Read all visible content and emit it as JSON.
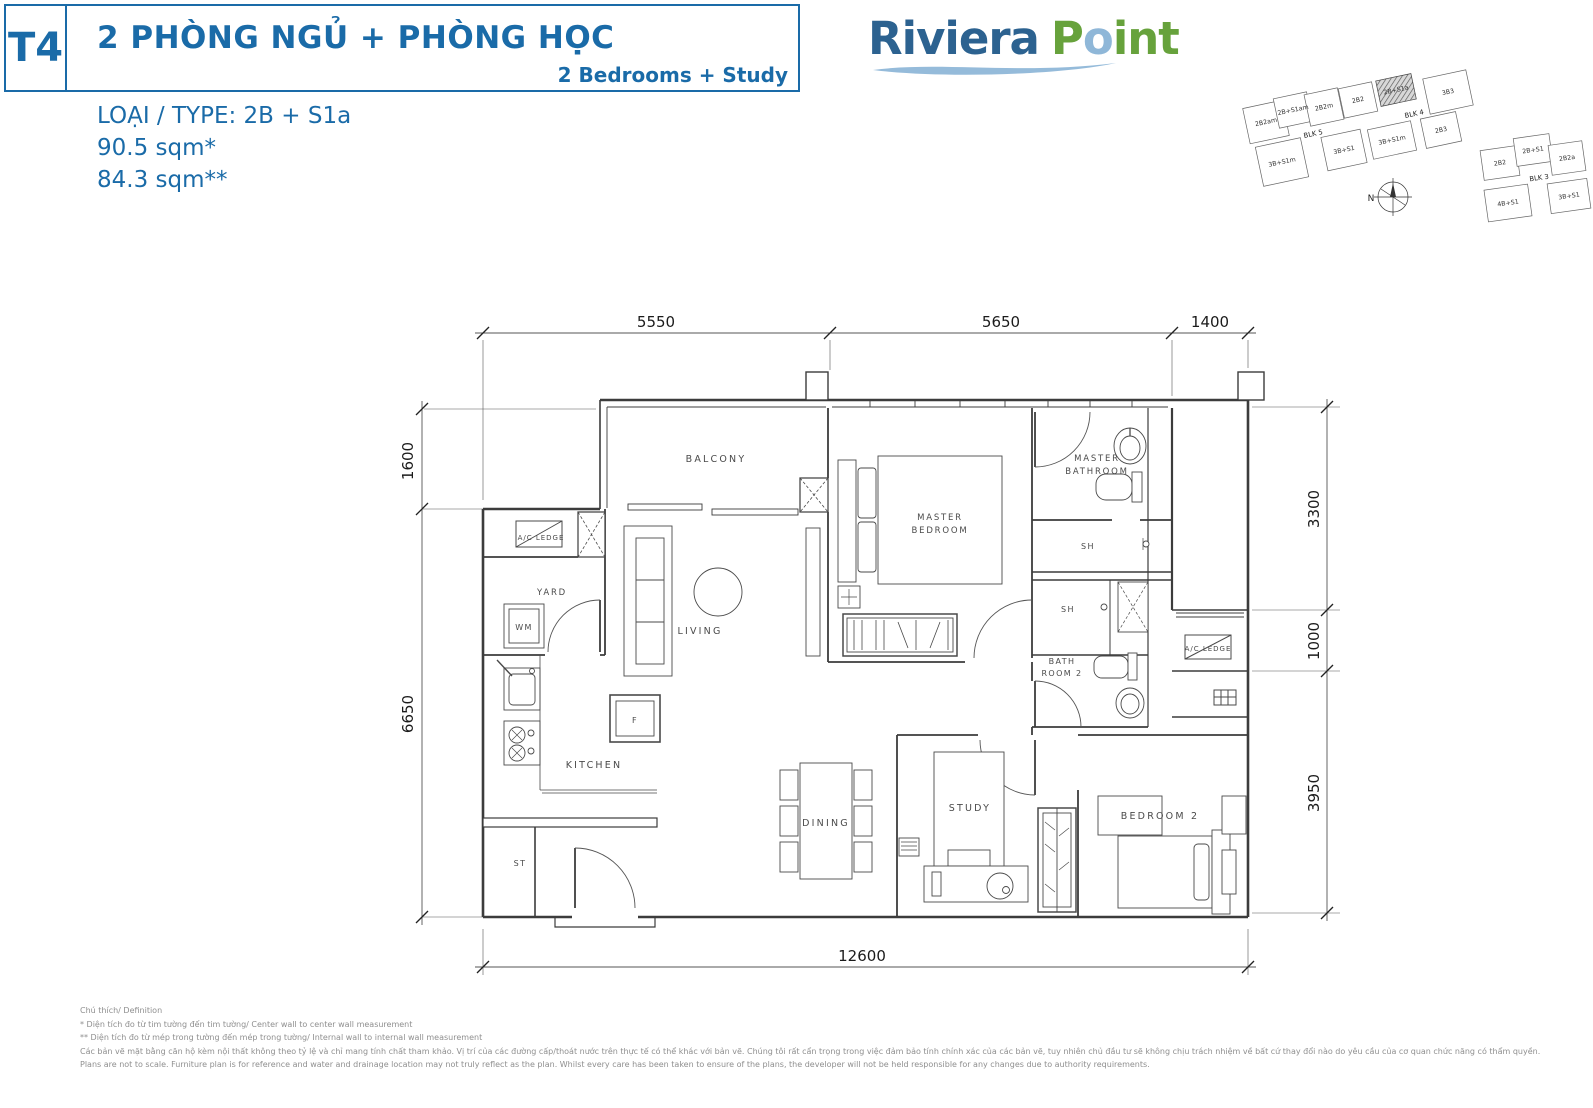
{
  "theme": {
    "brand-blue": "#1A6BA8",
    "logo-blue": "#2C6290",
    "logo-green": "#67A23C",
    "logo-light-blue": "#8FB7D8",
    "plan-line": "#3c3c3c",
    "label-gray": "#4a4a4a",
    "footer-gray": "#8f8f8f"
  },
  "header": {
    "unit_code": "T4",
    "title_vi": "2 PHÒNG NGỦ + PHÒNG HỌC",
    "title_en": "2 Bedrooms + Study"
  },
  "type_info": {
    "type_label": "LOẠI / TYPE: 2B + S1a",
    "area_line1": "90.5 sqm*",
    "area_line2": "84.3 sqm**"
  },
  "logo": {
    "word1": "Riviera",
    "p": "P",
    "o": "o",
    "int": "int"
  },
  "site_map": {
    "compass": "N",
    "highlighted_unit": "2B+S1a",
    "cluster_a": [
      "2B2am",
      "2B+S1am",
      "2B2m",
      "2B2",
      "2B+S1a",
      "3B3",
      "3B+S1m",
      "3B+S1",
      "3B+S1m",
      "2B3"
    ],
    "cluster_a_blocks": [
      "BLK 5",
      "BLK 4"
    ],
    "cluster_b": [
      "2B2",
      "2B+S1",
      "2B2a",
      "4B+S1",
      "3B+S1"
    ],
    "cluster_b_block": "BLK 3"
  },
  "floor_plan": {
    "labels": {
      "balcony": "BALCONY",
      "ac_ledge": "A/C LEDGE",
      "yard": "YARD",
      "wm": "WM",
      "living": "LIVING",
      "kitchen": "KITCHEN",
      "fridge": "F",
      "store": "ST",
      "dining": "DINING",
      "study": "STUDY",
      "master_bedroom_l1": "MASTER",
      "master_bedroom_l2": "BEDROOM",
      "master_bathroom_l1": "MASTER",
      "master_bathroom_l2": "BATHROOM",
      "sh": "SH",
      "bathroom2_l1": "BATH",
      "bathroom2_l2": "ROOM 2",
      "bedroom2": "BEDROOM 2"
    },
    "dimensions": {
      "top": [
        "5550",
        "5650",
        "1400"
      ],
      "left": [
        "1600",
        "6650"
      ],
      "right": [
        "3300",
        "1000",
        "3950"
      ],
      "bottom": [
        "12600"
      ]
    }
  },
  "footer": {
    "line1": "Chú thích/ Definition",
    "line2": "* Diện tích đo từ tim tường đến tim tường/ Center wall to center wall measurement",
    "line3": "** Diện tích đo từ mép trong tường đến mép trong tường/ Internal wall to internal wall measurement",
    "line4": "Các bản vẽ mặt bằng căn hộ kèm nội thất không theo tỷ lệ và chỉ mang tính chất tham khảo. Vị trí của các đường cấp/thoát nước trên thực tế có thể khác với bản vẽ. Chúng tôi rất cẩn trọng trong việc đảm bảo tính chính xác của các bản vẽ, tuy nhiên chủ đầu tư sẽ không chịu trách nhiệm về bất cứ thay đổi nào do yêu cầu của cơ quan chức năng có thẩm quyền.",
    "line5": "Plans are not to scale. Furniture plan is for reference and water and drainage location may not truly reflect as the plan. Whilst every care has been taken to ensure of the plans, the developer will not be held responsible for any changes due to authority requirements."
  }
}
